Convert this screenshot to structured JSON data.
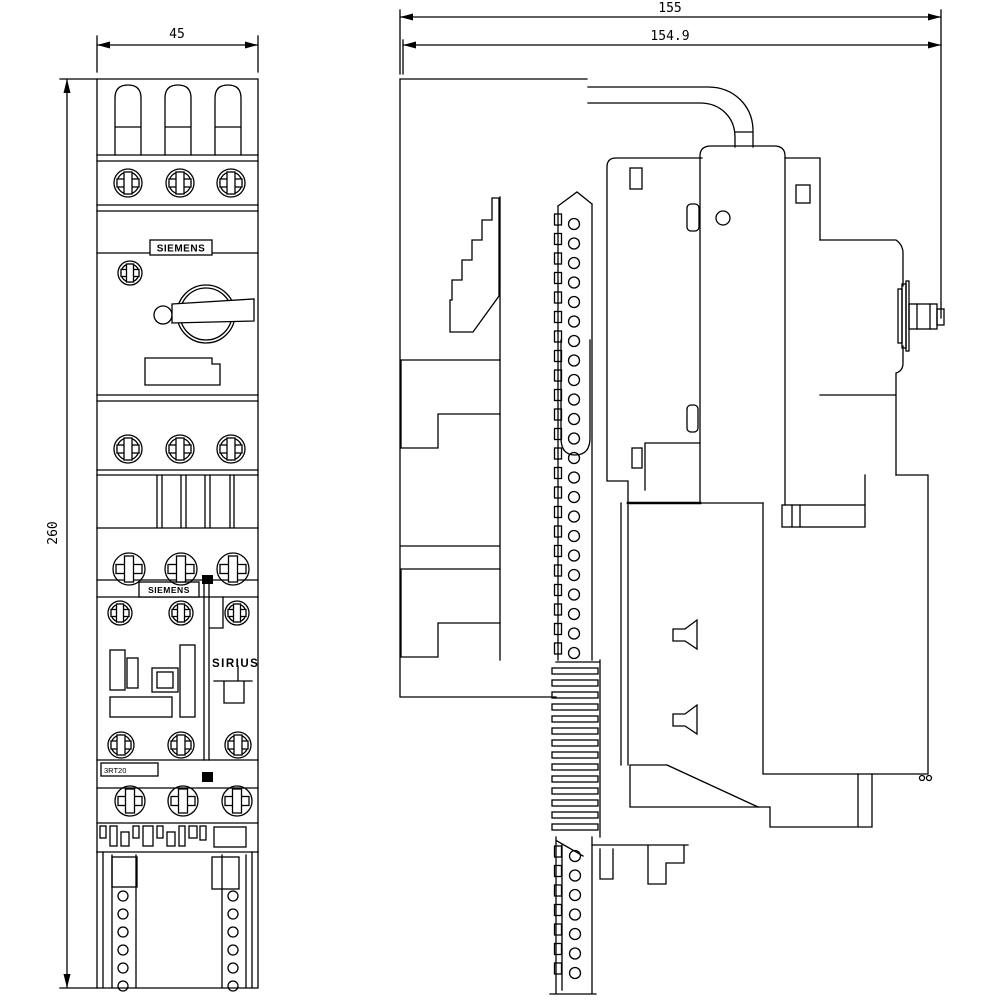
{
  "dimensions": {
    "front_width_mm": "45",
    "overall_height_mm": "260",
    "side_depth_total_mm": "155",
    "side_depth_device_mm": "154.9"
  },
  "labels": {
    "brand_top": "SIEMENS",
    "brand_bottom": "SIEMENS",
    "series": "SIRIUS",
    "model": "3RT20"
  }
}
